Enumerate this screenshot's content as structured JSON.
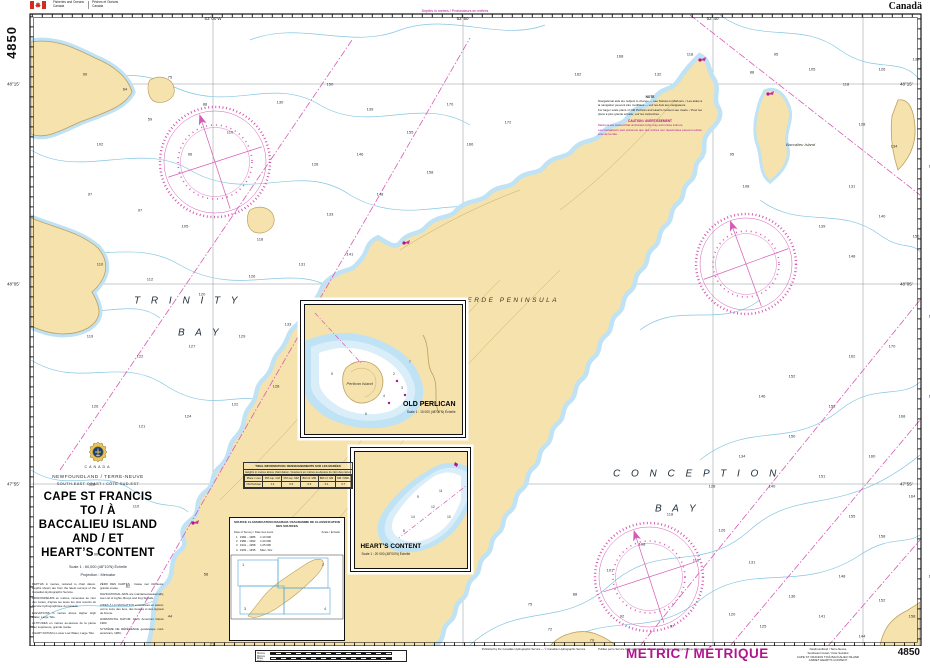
{
  "header": {
    "dept_en1": "Fisheries and Oceans",
    "dept_en2": "Canada",
    "dept_fr1": "Pêches et Océans",
    "dept_fr2": "Canada",
    "wordmark": "Canadä",
    "side_chart_no": "4850"
  },
  "title_block": {
    "country": "CANADA",
    "region": "NEWFOUNDLAND / TERRE-NEUVE",
    "coast": "SOUTH-EAST COAST / CÔTE SUD-EST",
    "title_lines": [
      "CAPE ST FRANCIS",
      "TO / À",
      "BACCALIEU ISLAND",
      "AND / ET",
      "HEART’S CONTENT"
    ],
    "scale": "Scale 1 : 60,000 (48°10'N) Échelle",
    "projection": "Projection : Mercator",
    "notes_col1": [
      "DEPTHS in metres, reduced to chart datum. Depths shown are from the latest surveys of the Canadian Hydrographic Service.",
      "PROFONDEURS en mètres, ramenées au zéro des cartes, d'après les levés les plus récents du Service hydrographique du Canada.",
      "ELEVATIONS in metres above Higher High Water, Large Tide.",
      "ALTITUDES en mètres au-dessus de la pleine mer supérieure, grande marée.",
      "CHART DATUM is Lower Low Water, Large Tide."
    ],
    "notes_col2": [
      "ZÉRO DES CARTES : basse mer inférieure, grande marée.",
      "NAVIGATIONAL AIDS are maintained seasonally; see List of Lights, Buoys and Fog Signals.",
      "AIDES À LA NAVIGATION entretenues en saison; voir le Livre des feux, des bouées et des signaux de brume.",
      "HORIZONTAL DATUM: North American Datum 1983.",
      "SYSTÈME DE RÉFÉRENCE géodésique nord-américain, 1983."
    ]
  },
  "map_labels": [
    {
      "t": "T R I N I T Y",
      "x": 104,
      "y": 287,
      "c": "sea-label"
    },
    {
      "t": "B A Y",
      "x": 148,
      "y": 319,
      "c": "sea-label"
    },
    {
      "t": "C O N C E P T I O N",
      "x": 583,
      "y": 460,
      "c": "sea-label"
    },
    {
      "t": "B A Y",
      "x": 625,
      "y": 495,
      "c": "sea-label"
    },
    {
      "t": "BAY  DE  VERDE  PENINSULA",
      "x": 388,
      "y": 283,
      "c": "land-label"
    },
    {
      "t": "Baccalieu Island",
      "x": 756,
      "y": 128,
      "c": "isle-label"
    }
  ],
  "edge_ticks": {
    "top": [
      {
        "t": "53°00'W",
        "x": 213,
        "y": 16
      },
      {
        "t": "52°50'",
        "x": 463,
        "y": 16
      },
      {
        "t": "52°40'",
        "x": 713,
        "y": 16
      }
    ],
    "bottom": [
      {
        "t": "53°00'W",
        "x": 213,
        "y": 648
      },
      {
        "t": "52°50'",
        "x": 463,
        "y": 648
      },
      {
        "t": "52°40'",
        "x": 713,
        "y": 648
      }
    ],
    "left": [
      {
        "t": "48°15'",
        "x": 7,
        "y": 84
      },
      {
        "t": "48°05'",
        "x": 7,
        "y": 284
      },
      {
        "t": "47°55'",
        "x": 7,
        "y": 484
      }
    ],
    "right": [
      {
        "t": "48°15'",
        "x": 900,
        "y": 84
      },
      {
        "t": "48°05'",
        "x": 900,
        "y": 284
      },
      {
        "t": "47°55'",
        "x": 900,
        "y": 484
      }
    ]
  },
  "magenta_captions": [
    {
      "t": "Depths in metres / Profondeurs en mètres",
      "x": 455,
      "y": 9
    },
    {
      "t": "Depths in metres / Profondeurs en mètres",
      "x": 793,
      "y": 647
    }
  ],
  "soundings": [
    {
      "x": 55,
      "y": 60,
      "t": "90"
    },
    {
      "x": 95,
      "y": 75,
      "t": "64"
    },
    {
      "x": 140,
      "y": 63,
      "t": "75"
    },
    {
      "x": 175,
      "y": 90,
      "t": "88"
    },
    {
      "x": 120,
      "y": 105,
      "t": "59"
    },
    {
      "x": 70,
      "y": 130,
      "t": "102"
    },
    {
      "x": 160,
      "y": 140,
      "t": "96"
    },
    {
      "x": 200,
      "y": 118,
      "t": "110"
    },
    {
      "x": 250,
      "y": 88,
      "t": "130"
    },
    {
      "x": 300,
      "y": 70,
      "t": "150"
    },
    {
      "x": 340,
      "y": 95,
      "t": "139"
    },
    {
      "x": 230,
      "y": 225,
      "t": "118"
    },
    {
      "x": 285,
      "y": 150,
      "t": "128"
    },
    {
      "x": 330,
      "y": 140,
      "t": "146"
    },
    {
      "x": 380,
      "y": 118,
      "t": "155"
    },
    {
      "x": 420,
      "y": 90,
      "t": "170"
    },
    {
      "x": 60,
      "y": 180,
      "t": "97"
    },
    {
      "x": 110,
      "y": 196,
      "t": "97"
    },
    {
      "x": 155,
      "y": 212,
      "t": "105"
    },
    {
      "x": 300,
      "y": 200,
      "t": "133"
    },
    {
      "x": 350,
      "y": 180,
      "t": "148"
    },
    {
      "x": 400,
      "y": 158,
      "t": "158"
    },
    {
      "x": 440,
      "y": 130,
      "t": "166"
    },
    {
      "x": 478,
      "y": 108,
      "t": "172"
    },
    {
      "x": 70,
      "y": 250,
      "t": "110"
    },
    {
      "x": 120,
      "y": 265,
      "t": "112"
    },
    {
      "x": 172,
      "y": 280,
      "t": "120"
    },
    {
      "x": 222,
      "y": 262,
      "t": "126"
    },
    {
      "x": 272,
      "y": 250,
      "t": "131"
    },
    {
      "x": 320,
      "y": 240,
      "t": "141"
    },
    {
      "x": 60,
      "y": 322,
      "t": "119"
    },
    {
      "x": 110,
      "y": 342,
      "t": "122"
    },
    {
      "x": 162,
      "y": 332,
      "t": "127"
    },
    {
      "x": 212,
      "y": 322,
      "t": "129"
    },
    {
      "x": 258,
      "y": 310,
      "t": "133"
    },
    {
      "x": 65,
      "y": 392,
      "t": "126"
    },
    {
      "x": 112,
      "y": 412,
      "t": "121"
    },
    {
      "x": 158,
      "y": 402,
      "t": "124"
    },
    {
      "x": 205,
      "y": 390,
      "t": "122"
    },
    {
      "x": 246,
      "y": 372,
      "t": "128"
    },
    {
      "x": 62,
      "y": 470,
      "t": "118"
    },
    {
      "x": 106,
      "y": 492,
      "t": "110"
    },
    {
      "x": 66,
      "y": 540,
      "t": "96"
    },
    {
      "x": 98,
      "y": 572,
      "t": "82"
    },
    {
      "x": 140,
      "y": 602,
      "t": "44"
    },
    {
      "x": 182,
      "y": 630,
      "t": "21"
    },
    {
      "x": 176,
      "y": 560,
      "t": "58"
    },
    {
      "x": 208,
      "y": 600,
      "t": "27"
    },
    {
      "x": 484,
      "y": 640,
      "t": "60"
    },
    {
      "x": 520,
      "y": 615,
      "t": "72"
    },
    {
      "x": 500,
      "y": 590,
      "t": "75"
    },
    {
      "x": 545,
      "y": 580,
      "t": "88"
    },
    {
      "x": 562,
      "y": 626,
      "t": "70"
    },
    {
      "x": 592,
      "y": 602,
      "t": "92"
    },
    {
      "x": 624,
      "y": 640,
      "t": "85"
    },
    {
      "x": 642,
      "y": 612,
      "t": "97"
    },
    {
      "x": 580,
      "y": 556,
      "t": "101"
    },
    {
      "x": 612,
      "y": 530,
      "t": "108"
    },
    {
      "x": 640,
      "y": 500,
      "t": "118"
    },
    {
      "x": 666,
      "y": 546,
      "t": "116"
    },
    {
      "x": 692,
      "y": 516,
      "t": "126"
    },
    {
      "x": 702,
      "y": 600,
      "t": "120"
    },
    {
      "x": 722,
      "y": 548,
      "t": "131"
    },
    {
      "x": 733,
      "y": 612,
      "t": "125"
    },
    {
      "x": 762,
      "y": 582,
      "t": "136"
    },
    {
      "x": 772,
      "y": 640,
      "t": "130"
    },
    {
      "x": 792,
      "y": 602,
      "t": "141"
    },
    {
      "x": 812,
      "y": 562,
      "t": "148"
    },
    {
      "x": 832,
      "y": 622,
      "t": "144"
    },
    {
      "x": 852,
      "y": 586,
      "t": "152"
    },
    {
      "x": 872,
      "y": 640,
      "t": "150"
    },
    {
      "x": 882,
      "y": 602,
      "t": "158"
    },
    {
      "x": 902,
      "y": 562,
      "t": "160"
    },
    {
      "x": 682,
      "y": 472,
      "t": "128"
    },
    {
      "x": 712,
      "y": 442,
      "t": "134"
    },
    {
      "x": 742,
      "y": 472,
      "t": "140"
    },
    {
      "x": 762,
      "y": 422,
      "t": "150"
    },
    {
      "x": 792,
      "y": 462,
      "t": "151"
    },
    {
      "x": 822,
      "y": 502,
      "t": "155"
    },
    {
      "x": 852,
      "y": 522,
      "t": "158"
    },
    {
      "x": 882,
      "y": 482,
      "t": "164"
    },
    {
      "x": 906,
      "y": 442,
      "t": "170"
    },
    {
      "x": 842,
      "y": 442,
      "t": "160"
    },
    {
      "x": 872,
      "y": 402,
      "t": "168"
    },
    {
      "x": 902,
      "y": 382,
      "t": "173"
    },
    {
      "x": 802,
      "y": 392,
      "t": "158"
    },
    {
      "x": 762,
      "y": 362,
      "t": "152"
    },
    {
      "x": 822,
      "y": 342,
      "t": "162"
    },
    {
      "x": 862,
      "y": 332,
      "t": "170"
    },
    {
      "x": 902,
      "y": 302,
      "t": "178"
    },
    {
      "x": 732,
      "y": 382,
      "t": "146"
    },
    {
      "x": 722,
      "y": 58,
      "t": "88"
    },
    {
      "x": 746,
      "y": 40,
      "t": "95"
    },
    {
      "x": 782,
      "y": 55,
      "t": "105"
    },
    {
      "x": 816,
      "y": 70,
      "t": "118"
    },
    {
      "x": 852,
      "y": 55,
      "t": "126"
    },
    {
      "x": 886,
      "y": 45,
      "t": "132"
    },
    {
      "x": 910,
      "y": 75,
      "t": "140"
    },
    {
      "x": 832,
      "y": 110,
      "t": "128"
    },
    {
      "x": 864,
      "y": 132,
      "t": "134"
    },
    {
      "x": 902,
      "y": 152,
      "t": "143"
    },
    {
      "x": 822,
      "y": 172,
      "t": "131"
    },
    {
      "x": 852,
      "y": 202,
      "t": "140"
    },
    {
      "x": 886,
      "y": 222,
      "t": "150"
    },
    {
      "x": 906,
      "y": 252,
      "t": "160"
    },
    {
      "x": 822,
      "y": 242,
      "t": "148"
    },
    {
      "x": 792,
      "y": 212,
      "t": "139"
    },
    {
      "x": 716,
      "y": 172,
      "t": "108"
    },
    {
      "x": 702,
      "y": 140,
      "t": "95"
    },
    {
      "x": 548,
      "y": 60,
      "t": "162"
    },
    {
      "x": 590,
      "y": 42,
      "t": "168"
    },
    {
      "x": 628,
      "y": 60,
      "t": "132"
    },
    {
      "x": 660,
      "y": 40,
      "t": "118"
    }
  ],
  "insets": {
    "old_perlican": {
      "title": "OLD PERLICAN",
      "scale": "Scale 1 : 15 000 (48°00'N) Échelle",
      "island_label": "Perlican Island"
    },
    "hearts_content": {
      "title": "HEART’S CONTENT",
      "scale": "Scale 1 : 20 000 (48°00'N) Échelle"
    }
  },
  "note_box": {
    "h1": "NOTE",
    "p1": "Navigational aids are subject to change — see Notices to Mariners. / Les aides à la navigation peuvent être modifiées — voir les Avis aux navigateurs.",
    "p2": "For larger scale plans of Old Perlican and Heart's Content see insets. / Pour les plans à plus grande échelle, voir les cartouches.",
    "h2": "CAUTION / AVERTISSEMENT",
    "p3": "Mariners are warned that uncharted rocks may exist close inshore.",
    "p4": "Les navigateurs sont prévenus que des roches non répertoriées peuvent exister près de la côte."
  },
  "tidal": {
    "caption": "TIDAL INFORMATION / RENSEIGNEMENTS SUR LES MARÉES",
    "subcaption": "Heights in metres above chart datum / Hauteurs en mètres au-dessus du zéro des cartes",
    "headers": [
      "Place / Lieu",
      "PM sup. GM",
      "PM sup. MM",
      "BM inf. MM",
      "BM inf. GM",
      "NM / MWL"
    ],
    "rows": [
      [
        "Old Perlican",
        "1.2",
        "0.9",
        "0.3",
        "0.1",
        "0.7"
      ]
    ]
  },
  "source": {
    "caption": "SOURCE CLASSIFICATION DIAGRAM / DIAGRAMME DE CLASSIFICATION DES SOURCES",
    "col_a": "Date of Survey / Date des levés",
    "col_b": "Scale / Échelle",
    "rows": [
      "1   1984 – 1986      1:10 000",
      "2   1986 – 1992      1:20 000",
      "3   1941 – 1968      1:25 000",
      "4   1903 – 1935      Misc / Div"
    ]
  },
  "footer": {
    "metric": "METRIC / MÉTRIQUE",
    "pub_en": "Published by the Canadian Hydrographic Service — © Canadian Hydrographic Service",
    "pub_fr": "Publiée par le Service hydrographique du Canada — © Service hydrographique du Canada",
    "pub_note": "Corrections: Notices to Mariners / Corrections : Avis aux navigateurs",
    "units_top": "Metres Mètres",
    "units_bottom": "Miles Milles",
    "corner_lines": [
      "Newfoundland / Terre-Neuve",
      "Southeast Coast / Côte Sud-Est",
      "CAPE ST. FRANCIS TO/À BACCALIEU ISLAND",
      "AND/ET HEART’S CONTENT"
    ],
    "chart_no": "4850"
  }
}
